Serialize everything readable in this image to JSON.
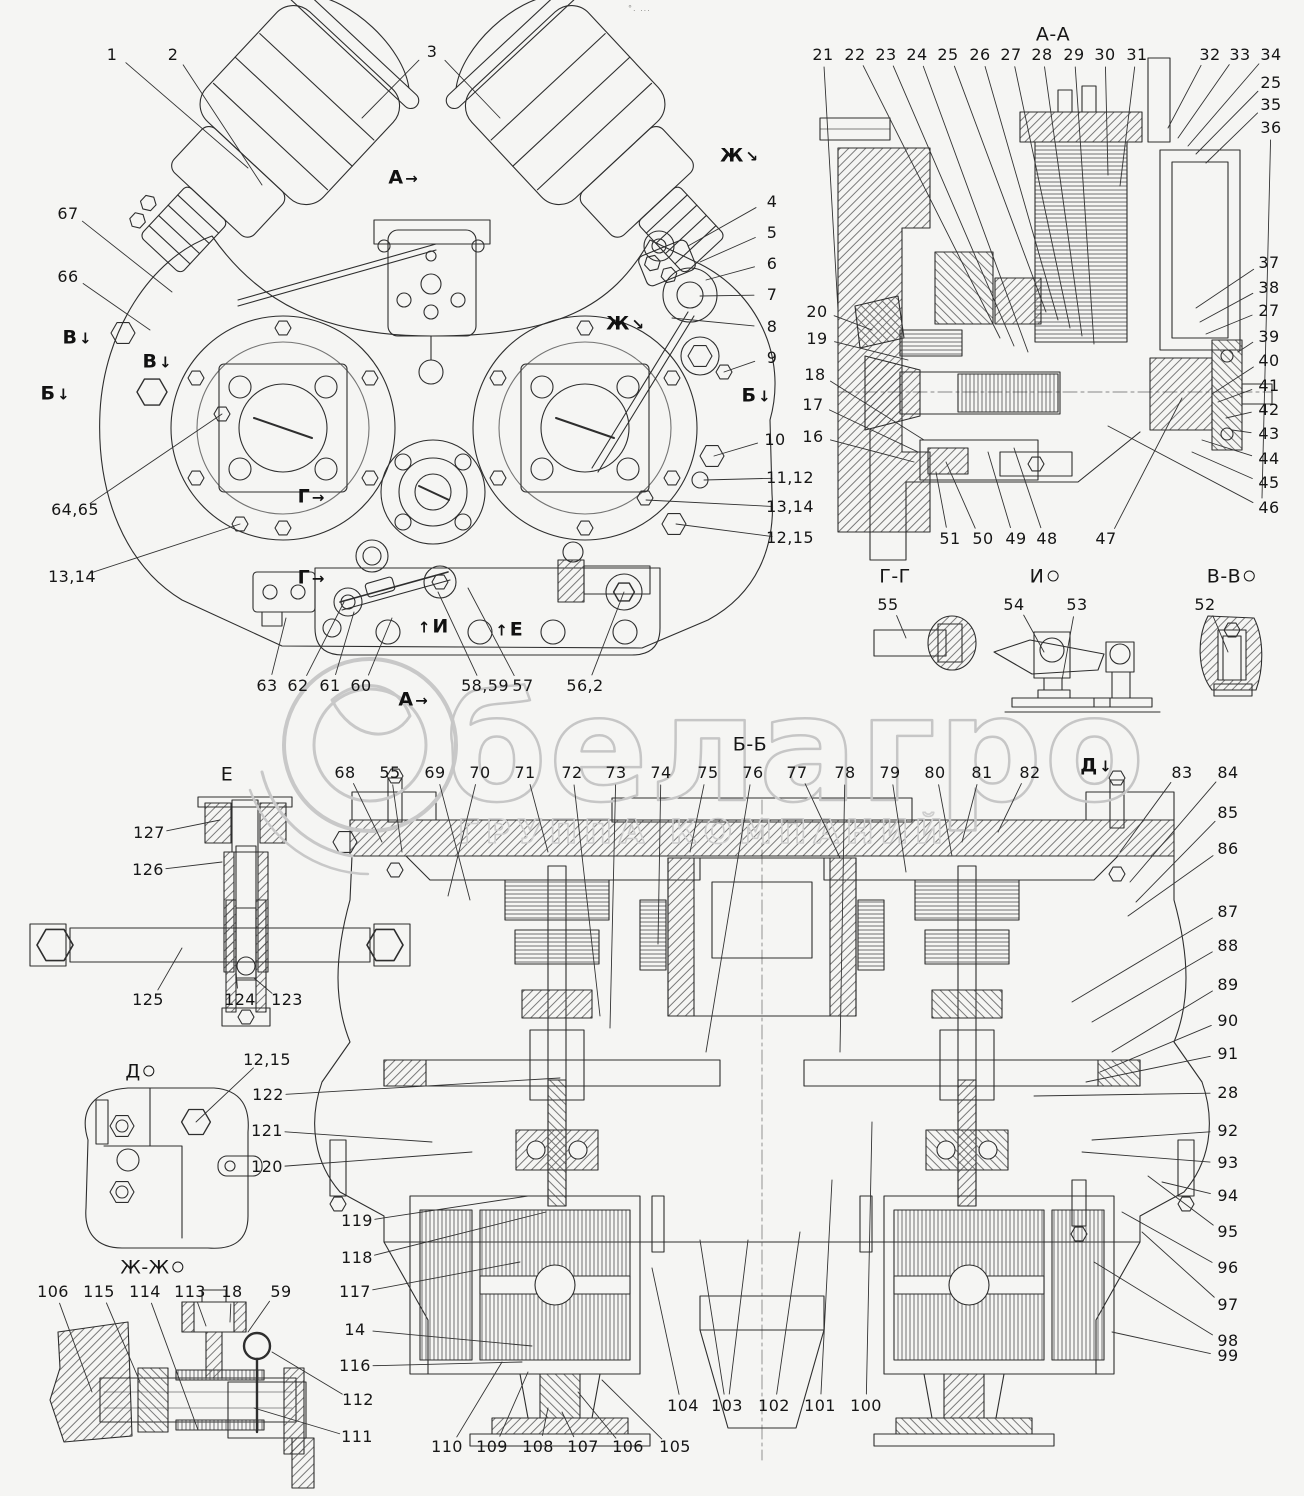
{
  "watermark": {
    "brand": "белагро",
    "tagline": "ГРУППА КОМПАНИЙ"
  },
  "artifact": "°. ...",
  "titles": [
    {
      "t": "А-А",
      "x": 1053,
      "y": 35
    },
    {
      "t": "Б-Б",
      "x": 750,
      "y": 745
    },
    {
      "t": "Г-Г",
      "x": 895,
      "y": 577
    },
    {
      "t": "И",
      "x": 1044,
      "y": 577,
      "rot": true
    },
    {
      "t": "В-В",
      "x": 1231,
      "y": 577,
      "rot": true
    },
    {
      "t": "Е",
      "x": 227,
      "y": 775
    },
    {
      "t": "Д",
      "x": 140,
      "y": 1072,
      "rot": true
    },
    {
      "t": "Ж-Ж",
      "x": 152,
      "y": 1268,
      "rot": true
    }
  ],
  "marks": [
    {
      "t": "В",
      "x": 78,
      "y": 338,
      "a": "↓"
    },
    {
      "t": "В",
      "x": 158,
      "y": 362,
      "a": "↓"
    },
    {
      "t": "Б",
      "x": 56,
      "y": 394,
      "a": "↓"
    },
    {
      "t": "А",
      "x": 404,
      "y": 178,
      "a": "→"
    },
    {
      "t": "Ж",
      "x": 740,
      "y": 156,
      "a": "↘"
    },
    {
      "t": "Ж",
      "x": 626,
      "y": 324,
      "a": "↘"
    },
    {
      "t": "Г",
      "x": 312,
      "y": 497,
      "a": "→"
    },
    {
      "t": "Г",
      "x": 312,
      "y": 578,
      "a": "→"
    },
    {
      "t": "А",
      "x": 414,
      "y": 700,
      "a": "→"
    },
    {
      "t": "И",
      "x": 432,
      "y": 627,
      "a": "↑",
      "pre": true
    },
    {
      "t": "Е",
      "x": 508,
      "y": 630,
      "a": "↑",
      "pre": true
    },
    {
      "t": "Б",
      "x": 757,
      "y": 396,
      "a": "↓"
    },
    {
      "t": "Д",
      "x": 1097,
      "y": 766,
      "a": "↓"
    }
  ],
  "labels": [
    {
      "t": "1",
      "x": 112,
      "y": 55,
      "u": 248,
      "v": 168
    },
    {
      "t": "2",
      "x": 173,
      "y": 55,
      "u": 262,
      "v": 185
    },
    {
      "t": "3",
      "x": 432,
      "y": 52,
      "u": 362,
      "v": 118,
      "u2": 500,
      "v2": 118
    },
    {
      "t": "67",
      "x": 68,
      "y": 214,
      "u": 172,
      "v": 292
    },
    {
      "t": "66",
      "x": 68,
      "y": 277,
      "u": 150,
      "v": 330
    },
    {
      "t": "64,65",
      "x": 75,
      "y": 510,
      "u": 222,
      "v": 414
    },
    {
      "t": "13,14",
      "x": 72,
      "y": 577,
      "u": 240,
      "v": 524
    },
    {
      "t": "63",
      "x": 267,
      "y": 686,
      "u": 286,
      "v": 618
    },
    {
      "t": "62",
      "x": 298,
      "y": 686,
      "u": 344,
      "v": 602
    },
    {
      "t": "61",
      "x": 330,
      "y": 686,
      "u": 354,
      "v": 612
    },
    {
      "t": "60",
      "x": 361,
      "y": 686,
      "u": 392,
      "v": 618
    },
    {
      "t": "58,59",
      "x": 485,
      "y": 686,
      "u": 438,
      "v": 592
    },
    {
      "t": "57",
      "x": 523,
      "y": 686,
      "u": 468,
      "v": 588
    },
    {
      "t": "56,2",
      "x": 585,
      "y": 686,
      "u": 624,
      "v": 592
    },
    {
      "t": "4",
      "x": 772,
      "y": 202,
      "u": 688,
      "v": 246
    },
    {
      "t": "5",
      "x": 772,
      "y": 233,
      "u": 700,
      "v": 262
    },
    {
      "t": "6",
      "x": 772,
      "y": 264,
      "u": 706,
      "v": 280
    },
    {
      "t": "7",
      "x": 772,
      "y": 295,
      "u": 700,
      "v": 296
    },
    {
      "t": "8",
      "x": 772,
      "y": 327,
      "u": 672,
      "v": 318
    },
    {
      "t": "9",
      "x": 772,
      "y": 358,
      "u": 724,
      "v": 372
    },
    {
      "t": "10",
      "x": 775,
      "y": 440,
      "u": 714,
      "v": 456
    },
    {
      "t": "11,12",
      "x": 790,
      "y": 478,
      "u": 704,
      "v": 480
    },
    {
      "t": "13,14",
      "x": 790,
      "y": 507,
      "u": 646,
      "v": 500
    },
    {
      "t": "12,15",
      "x": 790,
      "y": 538,
      "u": 676,
      "v": 524
    },
    {
      "t": "21",
      "x": 823,
      "y": 55,
      "u": 838,
      "v": 310
    },
    {
      "t": "22",
      "x": 855,
      "y": 55,
      "u": 1000,
      "v": 338
    },
    {
      "t": "23",
      "x": 886,
      "y": 55,
      "u": 1014,
      "v": 346
    },
    {
      "t": "24",
      "x": 917,
      "y": 55,
      "u": 1028,
      "v": 352
    },
    {
      "t": "25",
      "x": 948,
      "y": 55,
      "u": 1046,
      "v": 312
    },
    {
      "t": "26",
      "x": 980,
      "y": 55,
      "u": 1058,
      "v": 320
    },
    {
      "t": "27",
      "x": 1011,
      "y": 55,
      "u": 1070,
      "v": 328
    },
    {
      "t": "28",
      "x": 1042,
      "y": 55,
      "u": 1082,
      "v": 336
    },
    {
      "t": "29",
      "x": 1074,
      "y": 55,
      "u": 1094,
      "v": 344
    },
    {
      "t": "30",
      "x": 1105,
      "y": 55,
      "u": 1108,
      "v": 175
    },
    {
      "t": "31",
      "x": 1137,
      "y": 55,
      "u": 1120,
      "v": 186
    },
    {
      "t": "32",
      "x": 1210,
      "y": 55,
      "u": 1168,
      "v": 128
    },
    {
      "t": "33",
      "x": 1240,
      "y": 55,
      "u": 1178,
      "v": 138
    },
    {
      "t": "34",
      "x": 1271,
      "y": 55,
      "u": 1188,
      "v": 146
    },
    {
      "t": "25",
      "x": 1271,
      "y": 83,
      "u": 1196,
      "v": 154
    },
    {
      "t": "35",
      "x": 1271,
      "y": 105,
      "u": 1206,
      "v": 163
    },
    {
      "t": "36",
      "x": 1271,
      "y": 128,
      "u": 1262,
      "v": 498
    },
    {
      "t": "20",
      "x": 817,
      "y": 312,
      "u": 872,
      "v": 330
    },
    {
      "t": "19",
      "x": 817,
      "y": 339,
      "u": 908,
      "v": 360
    },
    {
      "t": "18",
      "x": 815,
      "y": 375,
      "u": 924,
      "v": 440
    },
    {
      "t": "17",
      "x": 813,
      "y": 405,
      "u": 918,
      "v": 452
    },
    {
      "t": "16",
      "x": 813,
      "y": 437,
      "u": 914,
      "v": 462
    },
    {
      "t": "37",
      "x": 1269,
      "y": 263,
      "u": 1196,
      "v": 308
    },
    {
      "t": "38",
      "x": 1269,
      "y": 288,
      "u": 1200,
      "v": 322
    },
    {
      "t": "27",
      "x": 1269,
      "y": 311,
      "u": 1206,
      "v": 334
    },
    {
      "t": "39",
      "x": 1269,
      "y": 337,
      "u": 1238,
      "v": 352
    },
    {
      "t": "40",
      "x": 1269,
      "y": 361,
      "u": 1212,
      "v": 394
    },
    {
      "t": "41",
      "x": 1269,
      "y": 386,
      "u": 1218,
      "v": 402
    },
    {
      "t": "42",
      "x": 1269,
      "y": 410,
      "u": 1226,
      "v": 418
    },
    {
      "t": "43",
      "x": 1269,
      "y": 434,
      "u": 1232,
      "v": 430
    },
    {
      "t": "44",
      "x": 1269,
      "y": 459,
      "u": 1202,
      "v": 440
    },
    {
      "t": "45",
      "x": 1269,
      "y": 483,
      "u": 1192,
      "v": 452
    },
    {
      "t": "46",
      "x": 1269,
      "y": 508,
      "u": 1108,
      "v": 426
    },
    {
      "t": "51",
      "x": 950,
      "y": 539,
      "u": 936,
      "v": 472
    },
    {
      "t": "50",
      "x": 983,
      "y": 539,
      "u": 946,
      "v": 462
    },
    {
      "t": "49",
      "x": 1016,
      "y": 539,
      "u": 988,
      "v": 452
    },
    {
      "t": "48",
      "x": 1047,
      "y": 539,
      "u": 1014,
      "v": 448
    },
    {
      "t": "47",
      "x": 1106,
      "y": 539,
      "u": 1182,
      "v": 398
    },
    {
      "t": "55",
      "x": 888,
      "y": 605,
      "u": 906,
      "v": 638
    },
    {
      "t": "54",
      "x": 1014,
      "y": 605,
      "u": 1044,
      "v": 652
    },
    {
      "t": "53",
      "x": 1077,
      "y": 605,
      "u": 1062,
      "v": 680
    },
    {
      "t": "52",
      "x": 1205,
      "y": 605,
      "u": 1228,
      "v": 652
    },
    {
      "t": "68",
      "x": 345,
      "y": 773,
      "u": 382,
      "v": 842
    },
    {
      "t": "55",
      "x": 390,
      "y": 773,
      "u": 402,
      "v": 852
    },
    {
      "t": "69",
      "x": 435,
      "y": 773,
      "u": 470,
      "v": 900
    },
    {
      "t": "70",
      "x": 480,
      "y": 773,
      "u": 448,
      "v": 896
    },
    {
      "t": "71",
      "x": 525,
      "y": 773,
      "u": 548,
      "v": 852
    },
    {
      "t": "72",
      "x": 572,
      "y": 773,
      "u": 600,
      "v": 1016
    },
    {
      "t": "73",
      "x": 616,
      "y": 773,
      "u": 610,
      "v": 1028
    },
    {
      "t": "74",
      "x": 661,
      "y": 773,
      "u": 658,
      "v": 944
    },
    {
      "t": "75",
      "x": 708,
      "y": 773,
      "u": 690,
      "v": 852
    },
    {
      "t": "76",
      "x": 753,
      "y": 773,
      "u": 706,
      "v": 1052
    },
    {
      "t": "77",
      "x": 797,
      "y": 773,
      "u": 840,
      "v": 858
    },
    {
      "t": "78",
      "x": 845,
      "y": 773,
      "u": 840,
      "v": 1052
    },
    {
      "t": "79",
      "x": 890,
      "y": 773,
      "u": 906,
      "v": 872
    },
    {
      "t": "80",
      "x": 935,
      "y": 773,
      "u": 952,
      "v": 856
    },
    {
      "t": "81",
      "x": 982,
      "y": 773,
      "u": 962,
      "v": 842
    },
    {
      "t": "82",
      "x": 1030,
      "y": 773,
      "u": 998,
      "v": 832
    },
    {
      "t": "83",
      "x": 1182,
      "y": 773,
      "u": 1120,
      "v": 852
    },
    {
      "t": "84",
      "x": 1228,
      "y": 773,
      "u": 1130,
      "v": 882
    },
    {
      "t": "85",
      "x": 1228,
      "y": 813,
      "u": 1136,
      "v": 902
    },
    {
      "t": "86",
      "x": 1228,
      "y": 849,
      "u": 1128,
      "v": 916
    },
    {
      "t": "87",
      "x": 1228,
      "y": 912,
      "u": 1072,
      "v": 1002
    },
    {
      "t": "88",
      "x": 1228,
      "y": 946,
      "u": 1092,
      "v": 1022
    },
    {
      "t": "89",
      "x": 1228,
      "y": 985,
      "u": 1112,
      "v": 1052
    },
    {
      "t": "90",
      "x": 1228,
      "y": 1021,
      "u": 1100,
      "v": 1072
    },
    {
      "t": "91",
      "x": 1228,
      "y": 1054,
      "u": 1086,
      "v": 1082
    },
    {
      "t": "28",
      "x": 1228,
      "y": 1093,
      "u": 1034,
      "v": 1096
    },
    {
      "t": "92",
      "x": 1228,
      "y": 1131,
      "u": 1092,
      "v": 1140
    },
    {
      "t": "93",
      "x": 1228,
      "y": 1163,
      "u": 1082,
      "v": 1152
    },
    {
      "t": "94",
      "x": 1228,
      "y": 1196,
      "u": 1162,
      "v": 1182
    },
    {
      "t": "95",
      "x": 1228,
      "y": 1232,
      "u": 1148,
      "v": 1176
    },
    {
      "t": "96",
      "x": 1228,
      "y": 1268,
      "u": 1122,
      "v": 1212
    },
    {
      "t": "97",
      "x": 1228,
      "y": 1305,
      "u": 1142,
      "v": 1232
    },
    {
      "t": "98",
      "x": 1228,
      "y": 1341,
      "u": 1094,
      "v": 1262
    },
    {
      "t": "99",
      "x": 1228,
      "y": 1356,
      "u": 1112,
      "v": 1332
    },
    {
      "t": "122",
      "x": 268,
      "y": 1095,
      "u": 560,
      "v": 1078
    },
    {
      "t": "121",
      "x": 267,
      "y": 1131,
      "u": 432,
      "v": 1142
    },
    {
      "t": "120",
      "x": 267,
      "y": 1167,
      "u": 472,
      "v": 1152
    },
    {
      "t": "119",
      "x": 357,
      "y": 1221,
      "u": 528,
      "v": 1196
    },
    {
      "t": "118",
      "x": 357,
      "y": 1258,
      "u": 546,
      "v": 1212
    },
    {
      "t": "117",
      "x": 355,
      "y": 1292,
      "u": 520,
      "v": 1262
    },
    {
      "t": "14",
      "x": 355,
      "y": 1330,
      "u": 532,
      "v": 1346
    },
    {
      "t": "116",
      "x": 355,
      "y": 1366,
      "u": 522,
      "v": 1362
    },
    {
      "t": "104",
      "x": 683,
      "y": 1406,
      "u": 652,
      "v": 1268
    },
    {
      "t": "103",
      "x": 727,
      "y": 1406,
      "u": 700,
      "v": 1240,
      "u2": 748,
      "v2": 1240
    },
    {
      "t": "102",
      "x": 774,
      "y": 1406,
      "u": 800,
      "v": 1232
    },
    {
      "t": "101",
      "x": 820,
      "y": 1406,
      "u": 832,
      "v": 1180
    },
    {
      "t": "100",
      "x": 866,
      "y": 1406,
      "u": 872,
      "v": 1122
    },
    {
      "t": "110",
      "x": 447,
      "y": 1447,
      "u": 502,
      "v": 1362
    },
    {
      "t": "109",
      "x": 492,
      "y": 1447,
      "u": 528,
      "v": 1372
    },
    {
      "t": "108",
      "x": 538,
      "y": 1447,
      "u": 548,
      "v": 1408
    },
    {
      "t": "107",
      "x": 583,
      "y": 1447,
      "u": 562,
      "v": 1412
    },
    {
      "t": "106",
      "x": 628,
      "y": 1447,
      "u": 578,
      "v": 1392
    },
    {
      "t": "105",
      "x": 675,
      "y": 1447,
      "u": 602,
      "v": 1380
    },
    {
      "t": "106",
      "x": 53,
      "y": 1292,
      "u": 92,
      "v": 1392
    },
    {
      "t": "115",
      "x": 99,
      "y": 1292,
      "u": 140,
      "v": 1382
    },
    {
      "t": "114",
      "x": 145,
      "y": 1292,
      "u": 198,
      "v": 1430
    },
    {
      "t": "113",
      "x": 190,
      "y": 1292,
      "u": 206,
      "v": 1326
    },
    {
      "t": "18",
      "x": 232,
      "y": 1292,
      "u": 230,
      "v": 1322
    },
    {
      "t": "59",
      "x": 281,
      "y": 1292,
      "u": 248,
      "v": 1332
    },
    {
      "t": "112",
      "x": 358,
      "y": 1400,
      "u": 272,
      "v": 1352
    },
    {
      "t": "111",
      "x": 357,
      "y": 1437,
      "u": 254,
      "v": 1408
    },
    {
      "t": "127",
      "x": 149,
      "y": 833,
      "u": 220,
      "v": 820
    },
    {
      "t": "126",
      "x": 148,
      "y": 870,
      "u": 222,
      "v": 862
    },
    {
      "t": "125",
      "x": 148,
      "y": 1000,
      "u": 182,
      "v": 948
    },
    {
      "t": "124",
      "x": 240,
      "y": 1000,
      "u": 236,
      "v": 972
    },
    {
      "t": "123",
      "x": 287,
      "y": 1000,
      "u": 254,
      "v": 978
    },
    {
      "t": "12,15",
      "x": 267,
      "y": 1060,
      "u": 196,
      "v": 1122
    }
  ]
}
